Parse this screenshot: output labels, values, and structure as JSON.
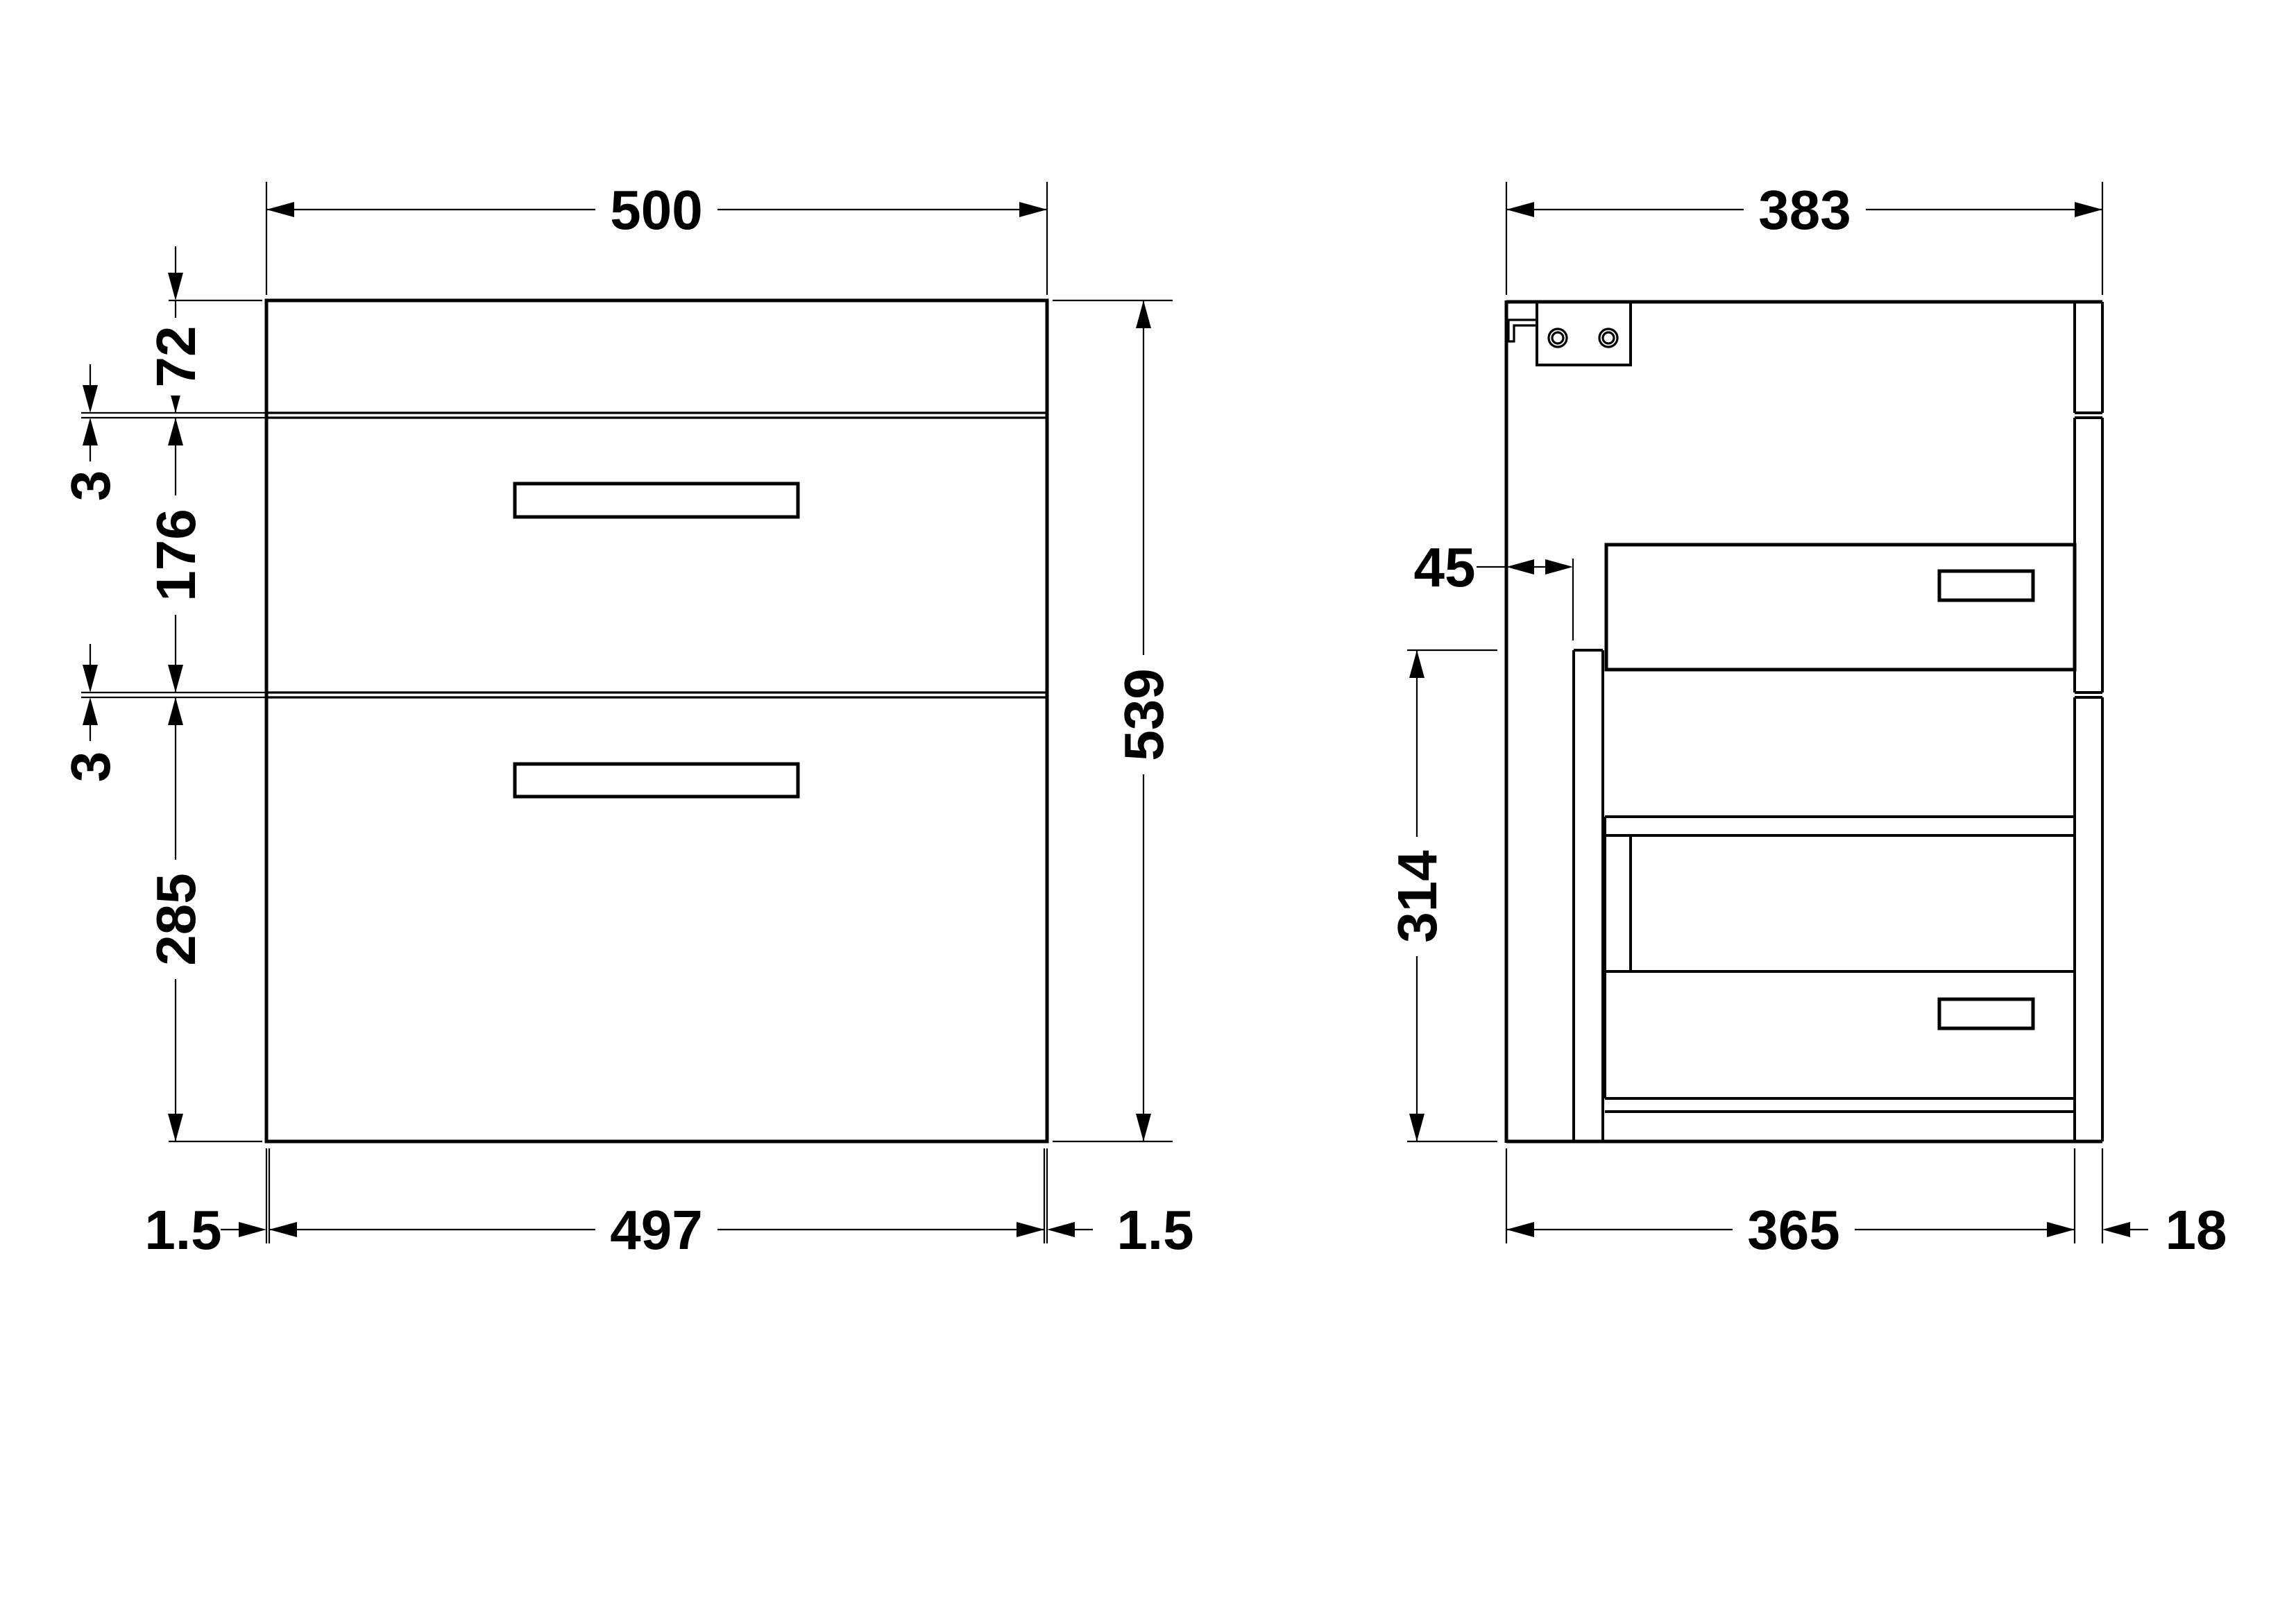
{
  "title": "vanity-unit-dimension-drawing",
  "colors": {
    "line": "#000000",
    "background": "#ffffff"
  },
  "front_view": {
    "top_width": "500",
    "top_section_height": "72",
    "gap_top": "3",
    "drawer1_height": "176",
    "gap_bottom": "3",
    "drawer2_height": "285",
    "total_height": "539",
    "bottom_edge_left": "1.5",
    "bottom_inner_width": "497",
    "bottom_edge_right": "1.5"
  },
  "side_view": {
    "top_depth": "383",
    "back_service_gap": "45",
    "upstand_height": "314",
    "carcass_depth": "365",
    "front_panel_thickness": "18"
  }
}
